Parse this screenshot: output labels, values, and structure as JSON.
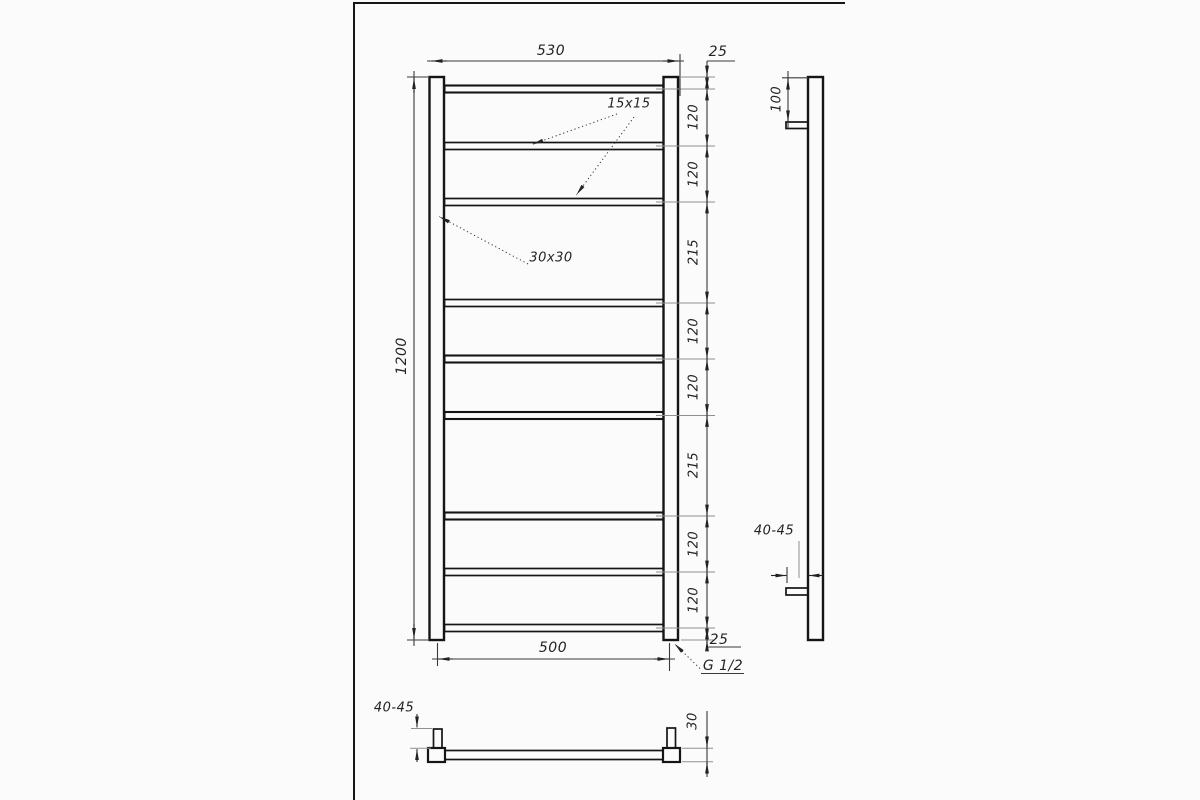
{
  "front_view": {
    "top_width": "530",
    "top_offset": "25",
    "height": "1200",
    "bottom_width": "500",
    "bottom_offset": "25",
    "rung_tube_size": "15x15",
    "post_tube_size": "30x30",
    "thread": "G 1/2",
    "spacings": [
      "120",
      "120",
      "215",
      "120",
      "120",
      "215",
      "120",
      "120"
    ]
  },
  "side_view": {
    "inlet_offset": "100",
    "wall_distance": "40-45"
  },
  "bottom_view": {
    "wall_distance": "40-45",
    "depth": "30"
  },
  "colors": {
    "background": "#fbfbfb",
    "object_line": "#151515",
    "dim_line": "#3a3a3a",
    "ext_line": "#8f8f8f",
    "text": "#232323"
  }
}
